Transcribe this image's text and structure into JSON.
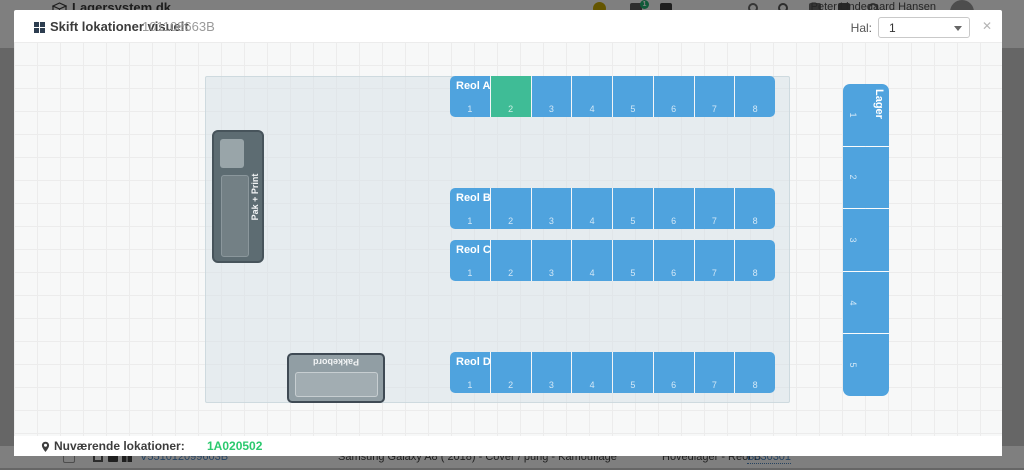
{
  "navbar": {
    "logo": "Lagersystem.dk",
    "badge": "1",
    "user": "Peter Lindegaard Hansen"
  },
  "modal": {
    "title": "Skift lokationer visuelt",
    "barcode": "101108663B",
    "hal_label": "Hal:",
    "hal_value": "1",
    "close_icon": "✕"
  },
  "floor": {
    "shelves": [
      {
        "id": "a",
        "label": "Reol A",
        "cells": [
          1,
          2,
          3,
          4,
          5,
          6,
          7,
          8
        ],
        "highlighted": 2
      },
      {
        "id": "b",
        "label": "Reol B",
        "cells": [
          1,
          2,
          3,
          4,
          5,
          6,
          7,
          8
        ],
        "highlighted": null
      },
      {
        "id": "c",
        "label": "Reol C",
        "cells": [
          1,
          2,
          3,
          4,
          5,
          6,
          7,
          8
        ],
        "highlighted": null
      },
      {
        "id": "d",
        "label": "Reol D",
        "cells": [
          1,
          2,
          3,
          4,
          5,
          6,
          7,
          8
        ],
        "highlighted": null
      }
    ],
    "lager": {
      "label": "Lager",
      "cells": [
        1,
        2,
        3,
        4,
        5
      ]
    },
    "pak_print_label": "Pak + Print",
    "pakkebord_label": "Pakkebord"
  },
  "footer": {
    "label": "Nuværende lokationer:",
    "location": "1A020502"
  },
  "background_row": {
    "sku": "V551012099603B",
    "product": "Samsung Galaxy A8 ( 2018) - Cover / pung - Kamouflage",
    "warehouse": "Hovedlager - Reol B",
    "location": "B030301"
  },
  "colors": {
    "cell_blue": "#4fa3de",
    "cell_green": "#3fbc96",
    "location_green": "#2bc96e"
  }
}
